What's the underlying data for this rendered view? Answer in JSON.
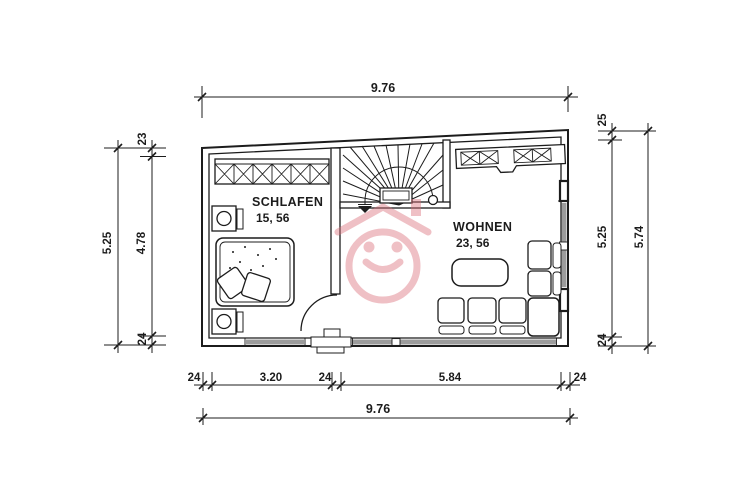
{
  "rooms": {
    "bedroom": {
      "name": "SCHLAFEN",
      "area": "15, 56"
    },
    "living": {
      "name": "WOHNEN",
      "area": "23, 56"
    }
  },
  "dims": {
    "top_total": "9.76",
    "bottom": {
      "left_wall": "24",
      "bedroom_width": "3.20",
      "pier": "24",
      "living_width": "5.84",
      "right_wall": "24",
      "total": "9.76"
    },
    "left": {
      "top": "23",
      "room": "4.78",
      "bottom": "24",
      "total": "5.25"
    },
    "right": {
      "top": "25",
      "room": "5.25",
      "bottom": "24",
      "total": "5.74"
    }
  },
  "icons": {
    "watermark": "house-smiley-watermark-icon",
    "stair_direction": "down-arrow-icon"
  },
  "colors": {
    "ink": "#1c1c1c",
    "watermark": "#db6c77",
    "window_fill": "#9c9c9c",
    "paper": "#ffffff"
  }
}
